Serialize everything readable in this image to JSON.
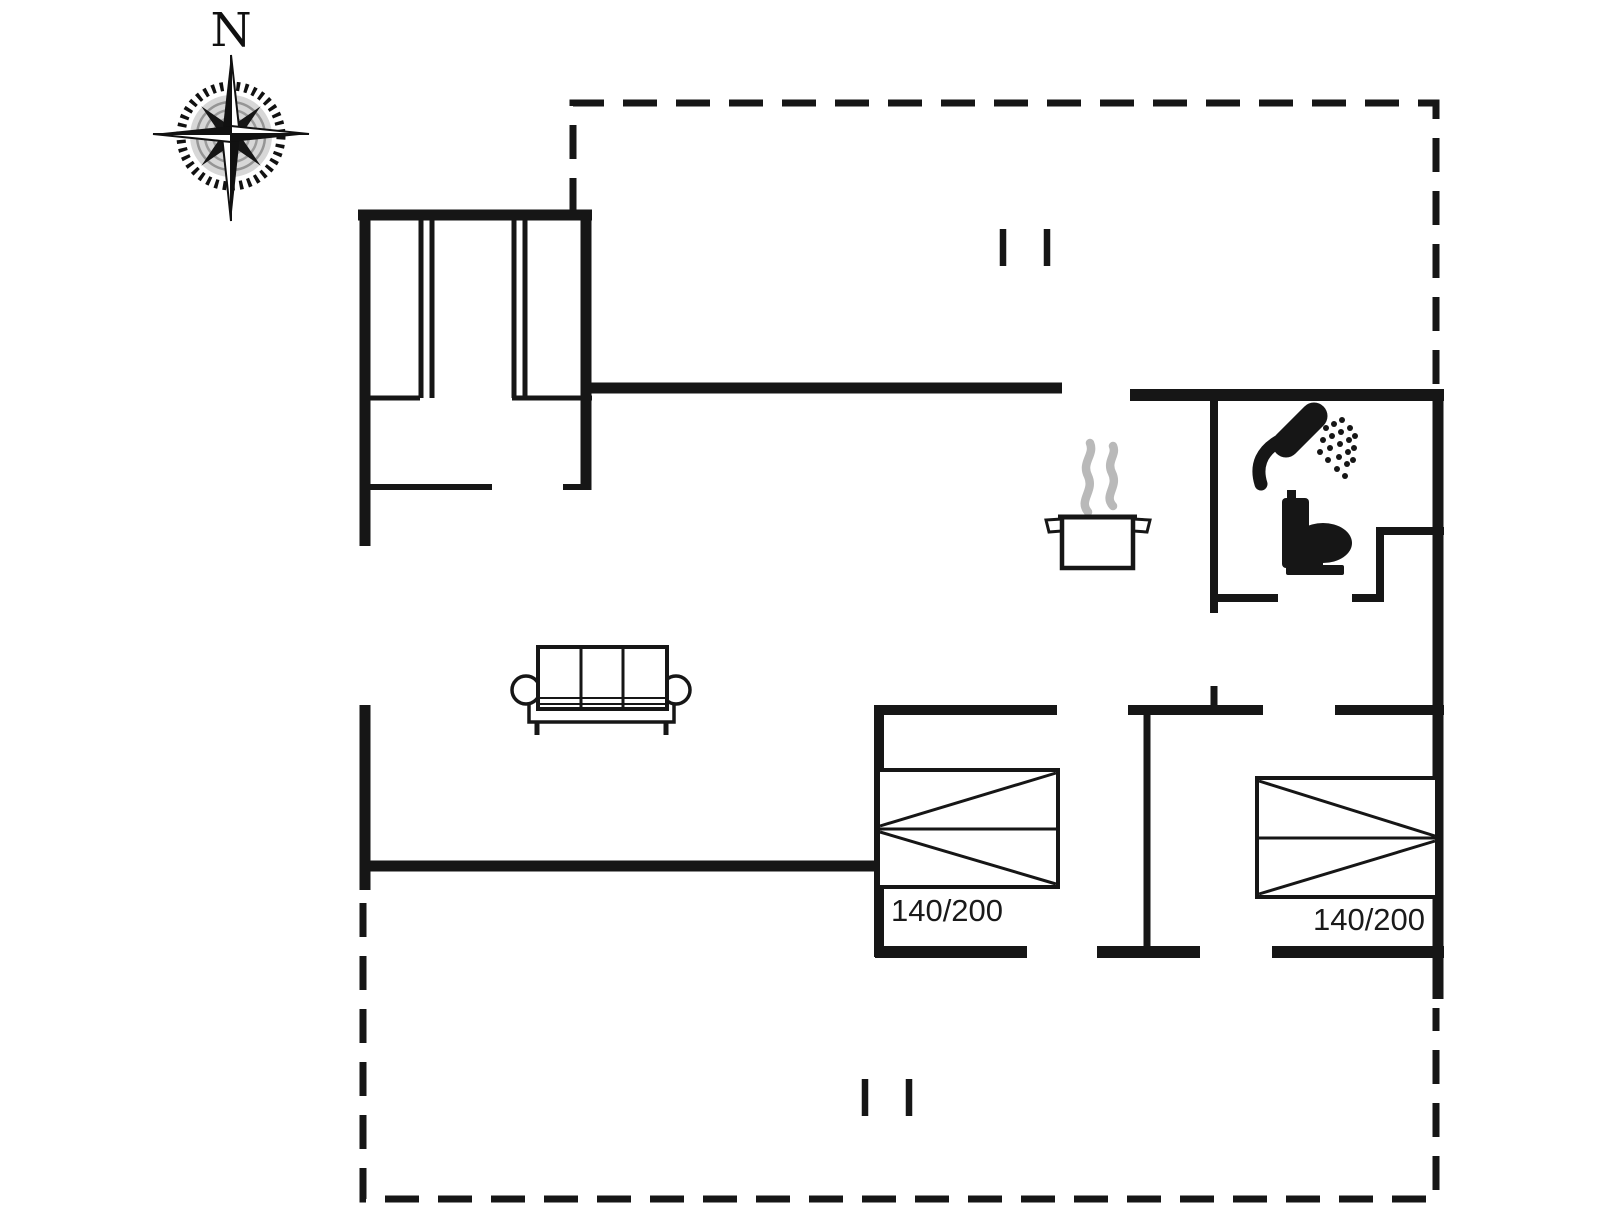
{
  "title": "Holiday home floor plan",
  "compass": {
    "label": "N"
  },
  "beds": {
    "bed1_label": "140/200",
    "bed2_label": "140/200"
  },
  "icons": {
    "compass": "compass-rose-icon",
    "shower": "shower-icon",
    "toilet": "toilet-icon",
    "stove": "cooking-pot-icon",
    "steam": "steam-icon",
    "sofa": "sofa-icon",
    "beds": "double-bed-icon",
    "openings": "terrace-opening-marks"
  },
  "colors": {
    "wall": "#161616",
    "steam": "#b9b9b9",
    "background": "#ffffff",
    "text": "#1a1a1a"
  }
}
